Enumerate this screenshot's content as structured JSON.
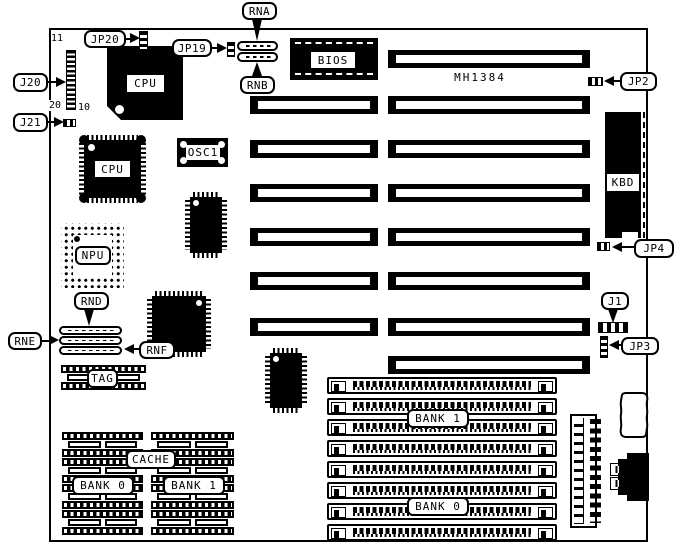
{
  "diagram": {
    "board": {
      "model": "MH1384"
    },
    "callouts": {
      "rna": "RNA",
      "rnb": "RNB",
      "rnd": "RND",
      "rne": "RNE",
      "rnf": "RNF",
      "j1": "J1",
      "j20": "J20",
      "j21": "J21",
      "jp2": "JP2",
      "jp3": "JP3",
      "jp4": "JP4",
      "jp19": "JP19",
      "jp20": "JP20"
    },
    "components": {
      "cpu1": "CPU",
      "cpu2": "CPU",
      "npu": "NPU",
      "bios": "BIOS",
      "osc1": "OSC1",
      "kbd": "KBD",
      "tag": "TAG",
      "cache": "CACHE",
      "cache_bank0": "BANK 0",
      "cache_bank1": "BANK 1",
      "simm_bank1": "BANK 1",
      "simm_bank0": "BANK 0"
    },
    "pin_numbers": {
      "j20_top": "11",
      "j20_bottom_left": "20",
      "j20_bottom_right": "10"
    },
    "colors": {
      "ink": "#000000",
      "background": "#ffffff"
    }
  }
}
